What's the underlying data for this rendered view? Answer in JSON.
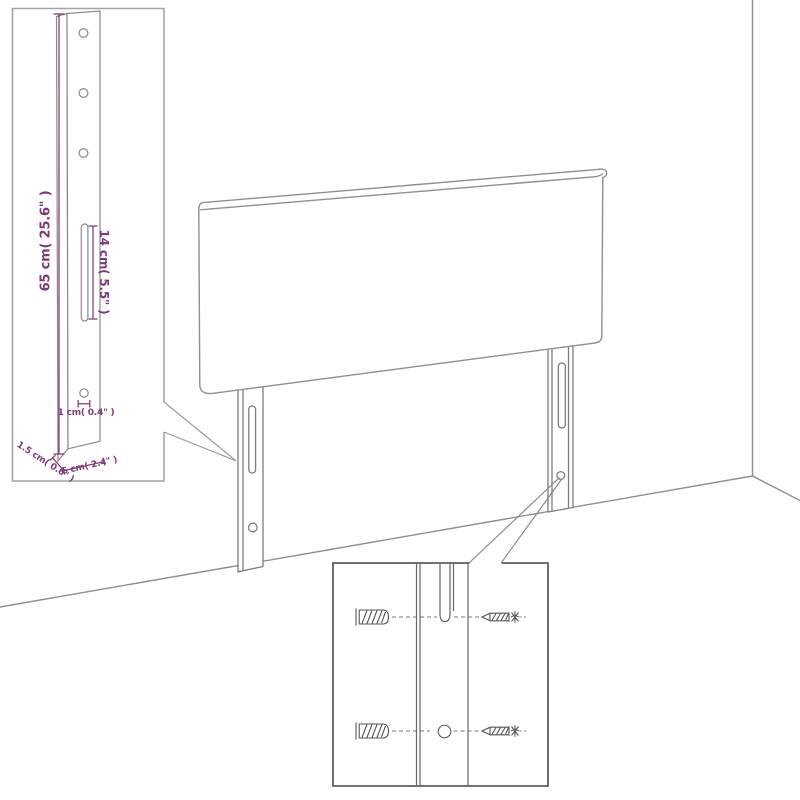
{
  "figure": {
    "type": "product-assembly-diagram",
    "subject": "upholstered headboard panel with two wall-mounting legs standing against a room corner",
    "background": "#ffffff"
  },
  "dimension_inset": {
    "description": "close-up of one mounting leg with dimensions",
    "height_label": "65 cm( 25.6\" )",
    "slot_label": "14 cm( 5.5\" )",
    "hole_label": "1 cm( 0.4\" )",
    "thickness_label": "1.5 cm( 0.6\" )",
    "width_label": "6 cm( 2.4\" )"
  },
  "mounting_inset": {
    "description": "close-up of leg hole with wall plugs and screws",
    "icons": [
      "wall-plug-icon",
      "screw-icon"
    ]
  },
  "colors": {
    "dimension_text": "#7e3a74",
    "line_art": "#8a8a8a",
    "line_art_dark": "#606060",
    "inset_border_light": "#a3a3a3",
    "inset_border_dark": "#5f5f5f",
    "background": "#ffffff"
  }
}
